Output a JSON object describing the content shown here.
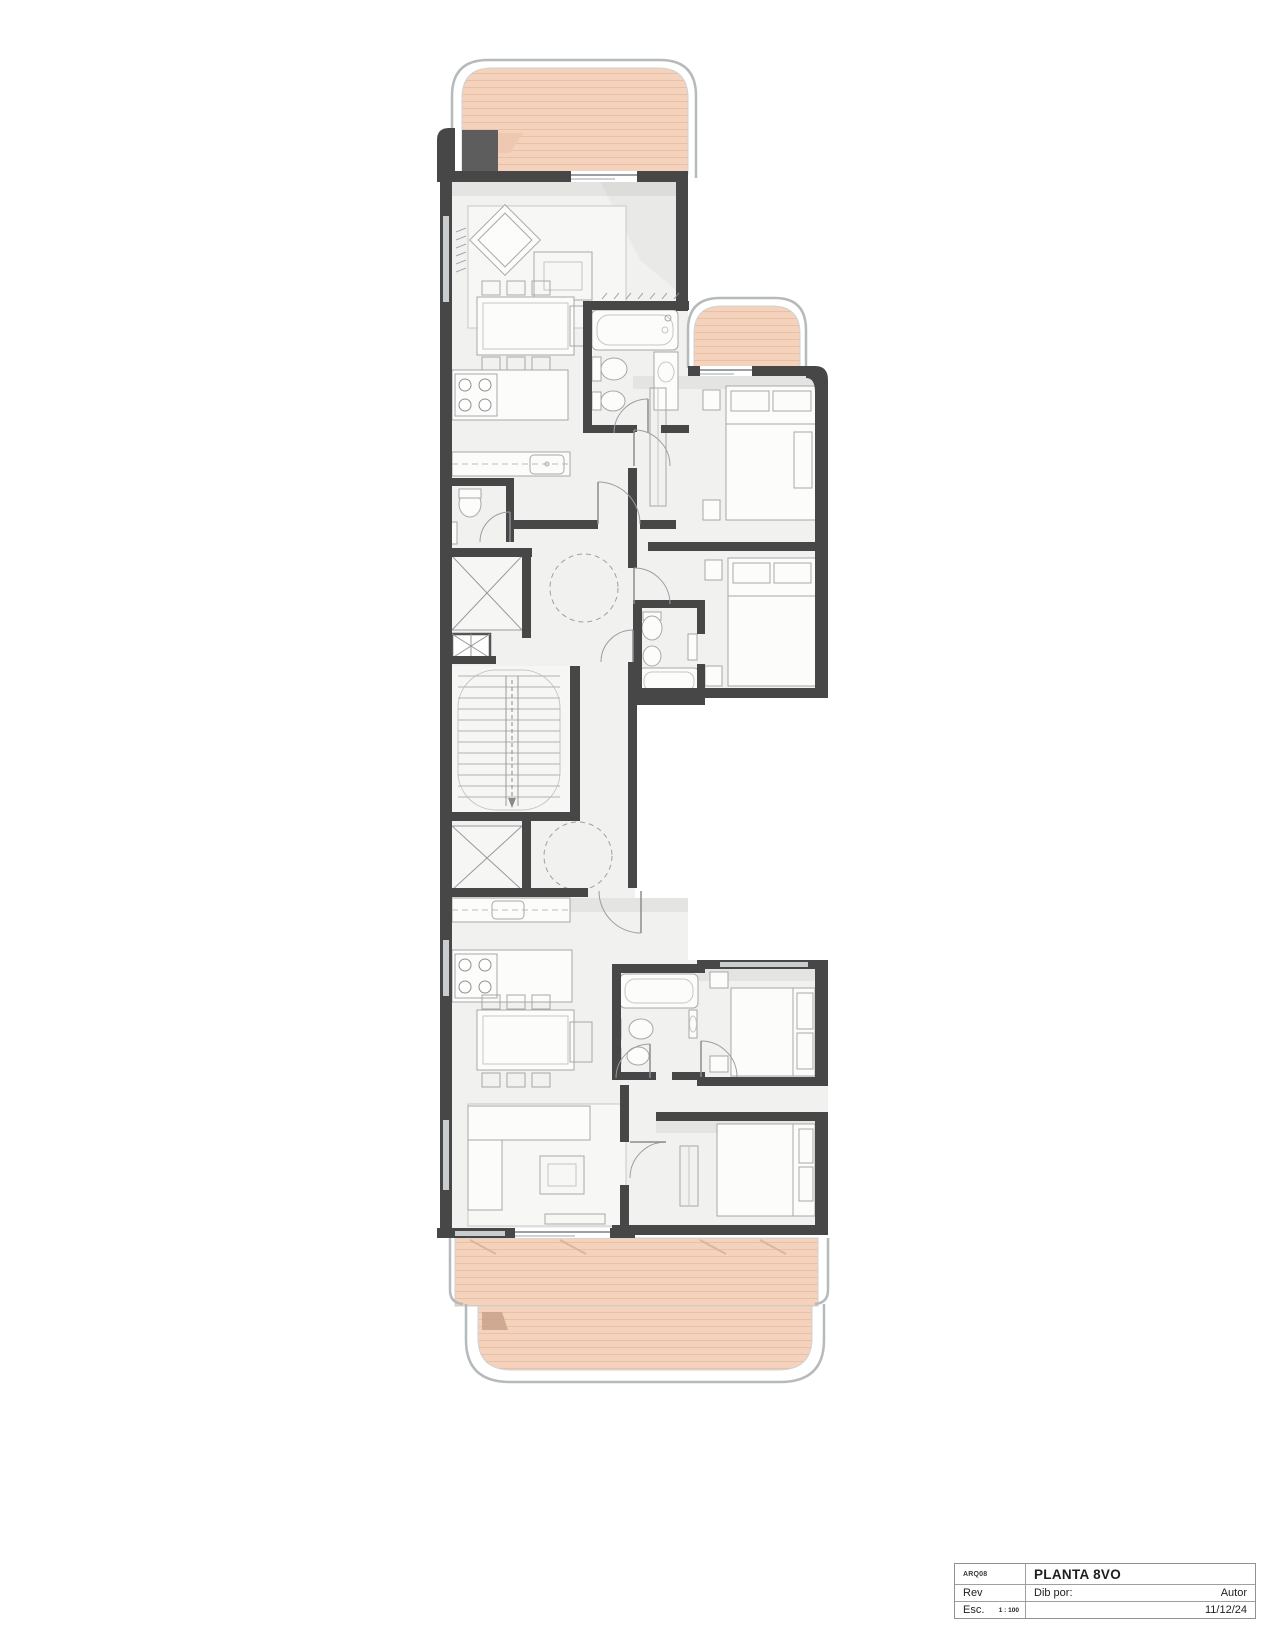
{
  "title_block": {
    "code": "ARQ08",
    "title": "PLANTA 8VO",
    "rev_label": "Rev",
    "drawn_by_label": "Dib por:",
    "author": "Autor",
    "scale_label": "Esc.",
    "scale_value": "1 : 100",
    "date": "11/12/24"
  },
  "colors": {
    "wall": "#474747",
    "floor": "#f1f1ef",
    "balcony": "#f4d2bc",
    "balcony_stripe": "#e8c0a8",
    "railing": "#b5babc",
    "furniture_line": "#a8a8a8"
  }
}
